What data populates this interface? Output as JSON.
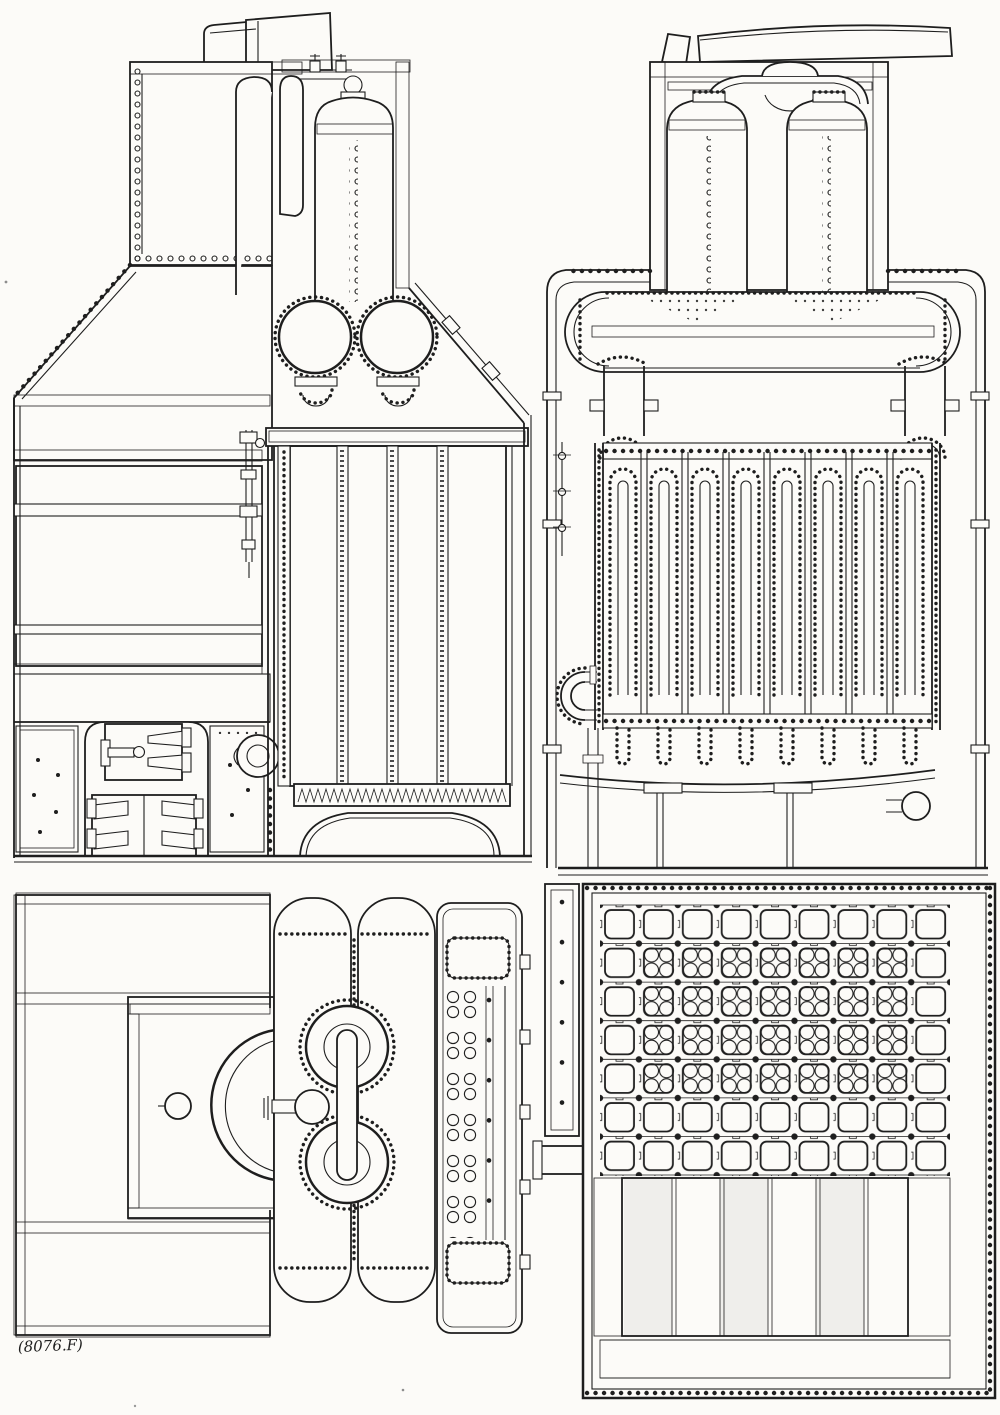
{
  "plate": {
    "caption": "(8076.F)",
    "paper_color": "#fcfbf8",
    "ink_color": "#1e1e1e",
    "views": [
      {
        "name": "boiler-side-elevation-icon"
      },
      {
        "name": "boiler-front-section-icon"
      },
      {
        "name": "boiler-plan-top-icon"
      },
      {
        "name": "boiler-plan-section-icon"
      }
    ]
  }
}
